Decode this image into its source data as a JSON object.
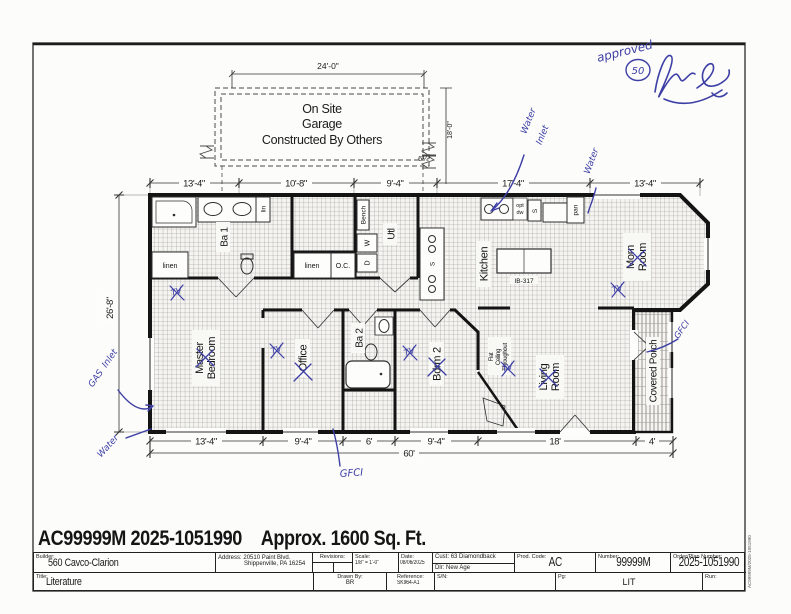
{
  "sheet": {
    "headline_model": "AC99999M 2025-1051990",
    "headline_area": "Approx. 1600 Sq. Ft.",
    "edge_text": "AC99999M/2025-1051990"
  },
  "garage": {
    "line1": "On Site",
    "line2": "Garage",
    "line3": "Constructed By Others",
    "dim_width": "24'-0\"",
    "dim_depth": "18'-0\"",
    "dim_offset": "6¼'"
  },
  "dims": {
    "top": [
      "13'-4\"",
      "10'-8\"",
      "9'-4\"",
      "17'-4\"",
      "13'-4\""
    ],
    "left": "26'-8\"",
    "bottom": [
      "13'-4\"",
      "9'-4\"",
      "6'",
      "9'-4\"",
      "18'",
      "4'"
    ],
    "overall": "60'"
  },
  "rooms": {
    "master1": "Master",
    "master2": "Bedroom",
    "office": "Office",
    "ba1": "Ba 1",
    "ba2": "Ba 2",
    "bdrm2": "Bdrm 2",
    "kitchen": "Kitchen",
    "utl": "Utl",
    "morn1": "Morn",
    "morn2": "Room",
    "living1": "Living",
    "living2": "Room",
    "porch": "Covered Porch",
    "flat1": "Flat",
    "flat2": "Ceiling",
    "flat3": "Throughout"
  },
  "fixtures": {
    "bench": "Bench",
    "pan": "pan",
    "lin": "lin",
    "linen_master": "linen",
    "linen_hall": "linen",
    "oc": "O.C.",
    "island": "IB-317",
    "opt": "opt",
    "dw": "dw",
    "washer": "W",
    "dryer": "D",
    "s": "S"
  },
  "handwriting": {
    "approved": "approved",
    "circled": "50",
    "water": "Water",
    "inlet": "Inlet",
    "gas": "GAS",
    "gfci": "GFCI",
    "tv": "TV"
  },
  "titleblock": {
    "builder_label": "Builder:",
    "builder": "560 Cavco-Clarion",
    "address_label": "Address:",
    "address1": "20510 Paint Blvd.",
    "address2": "Shippenville, PA 16254",
    "revisions_label": "Revisions:",
    "scale_label": "Scale:",
    "scale": "1/8\" = 1'-0\"",
    "date_label": "Date:",
    "date": "08/06/2025",
    "cust_label": "Cust:",
    "cust": "63 Diamondback",
    "dlr_label": "Dlr:",
    "dlr": "New Age",
    "prod_label": "Prod. Code:",
    "prod": "AC",
    "number_label": "Number:",
    "number": "99999M",
    "order_label": "Order/Plan Number:",
    "order": "2025-1051990",
    "title_label": "Title:",
    "title": "Literature",
    "drawn_label": "Drawn By:",
    "drawn": "BR",
    "reference_label": "Reference:",
    "reference": "SK964-A1",
    "sn_label": "S/N:",
    "pg_label": "Pg:",
    "pg": "LIT",
    "run_label": "Run:"
  }
}
